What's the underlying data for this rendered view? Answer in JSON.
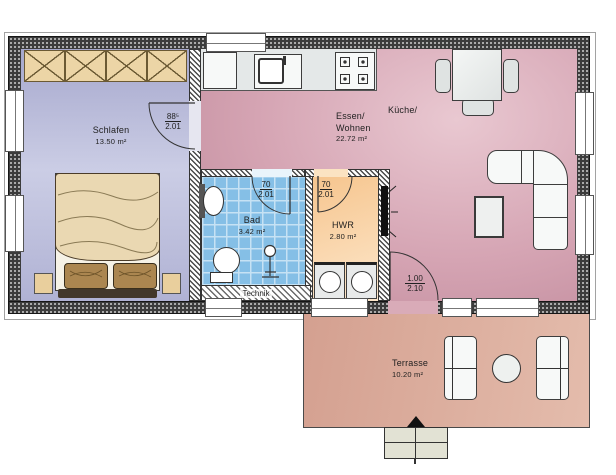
{
  "rooms": {
    "schlafen": {
      "name": "Schlafen",
      "area": "13.50 m²"
    },
    "essen_wohnen": {
      "name_line1": "Essen/",
      "name_line2": "Wohnen",
      "area": "22.72 m²"
    },
    "kueche": {
      "name": "Küche/"
    },
    "bad": {
      "name": "Bad",
      "area": "3.42 m²"
    },
    "hwr": {
      "name": "HWR",
      "area": "2.80 m²"
    },
    "technik": {
      "name": "Technik"
    },
    "terrasse": {
      "name": "Terrasse",
      "area": "10.20 m²"
    }
  },
  "doors": {
    "schlafen_door": {
      "width": "88⁵",
      "height": "2.01"
    },
    "bad_door": {
      "width": "70",
      "height": "2.01"
    },
    "hwr_door": {
      "width": "70",
      "height": "2.01"
    },
    "terrasse_door": {
      "width": "1.00",
      "height": "2.10"
    }
  },
  "colors": {
    "exterior_wall": "#3c3c3c",
    "schlafen_floor": "#b9bbdb",
    "wohnen_floor": "#d5a6b4",
    "bad_floor": "#8ec7ea",
    "hwr_floor": "#f8d0a0",
    "terrasse_floor": "#dcab9a",
    "wardrobe": "#ecd5a6"
  }
}
